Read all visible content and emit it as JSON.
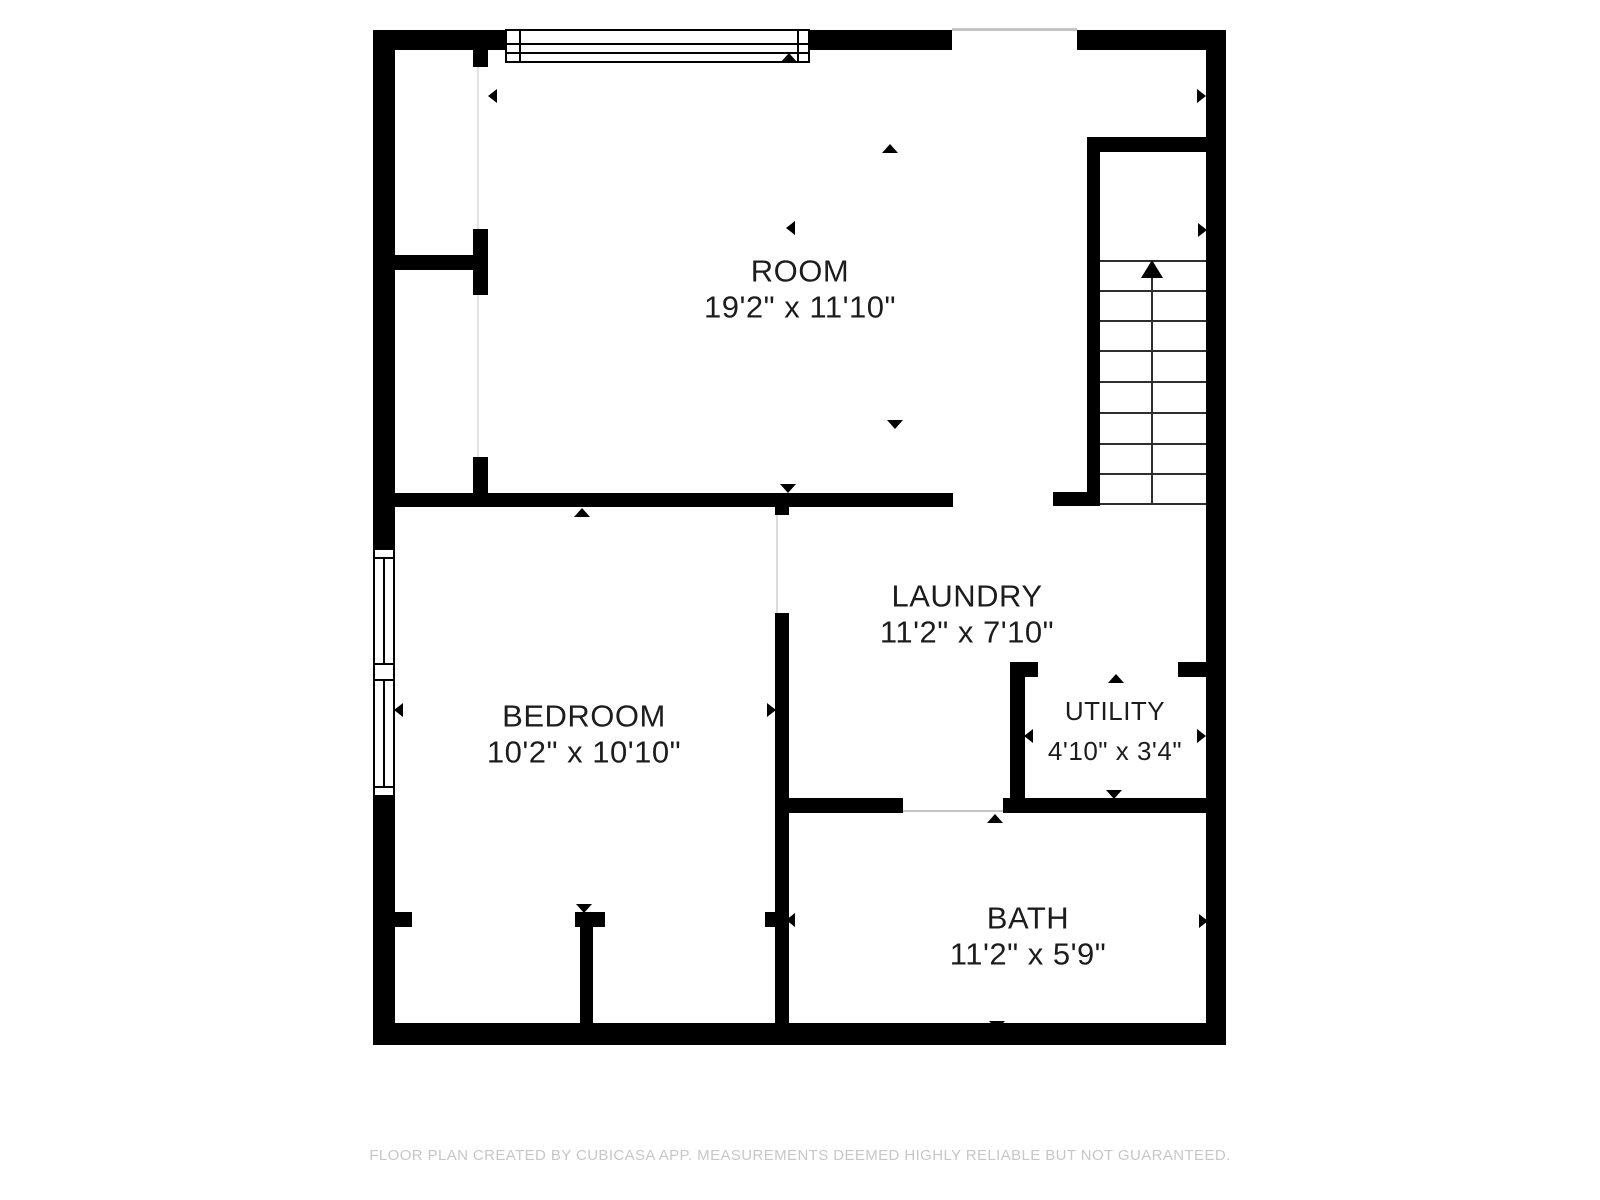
{
  "page": {
    "background": "#ffffff",
    "width": 1600,
    "height": 1200
  },
  "colors": {
    "wall": "#000000",
    "label_text": "#1c1c1c",
    "footer_text": "#c7c7c7",
    "opening_line": "#c4c4c4",
    "stair_line": "#2e2e2e"
  },
  "footer": {
    "text": "FLOOR PLAN CREATED BY CUBICASA APP. MEASUREMENTS DEEMED HIGHLY RELIABLE BUT NOT GUARANTEED.",
    "y": 1147
  },
  "rooms": [
    {
      "id": "room",
      "name": "ROOM",
      "dims": "19'2\" x 11'10\"",
      "x": 800,
      "y": 271,
      "dims_dy": 36,
      "font_size": 31
    },
    {
      "id": "bedroom",
      "name": "BEDROOM",
      "dims": "10'2\" x 10'10\"",
      "x": 584,
      "y": 716,
      "dims_dy": 36,
      "font_size": 31
    },
    {
      "id": "laundry",
      "name": "LAUNDRY",
      "dims": "11'2\" x 7'10\"",
      "x": 967,
      "y": 596,
      "dims_dy": 36,
      "font_size": 31
    },
    {
      "id": "utility",
      "name": "UTILITY",
      "dims": "4'10\" x 3'4\"",
      "x": 1115,
      "y": 711,
      "dims_dy": 40,
      "font_size": 26
    },
    {
      "id": "bath",
      "name": "BATH",
      "dims": "11'2\" x 5'9\"",
      "x": 1028,
      "y": 918,
      "dims_dy": 36,
      "font_size": 31
    }
  ],
  "plan": {
    "walls": [
      {
        "x": 373,
        "y": 30,
        "w": 22,
        "h": 520
      },
      {
        "x": 373,
        "y": 795,
        "w": 22,
        "h": 250
      },
      {
        "x": 373,
        "y": 30,
        "w": 138,
        "h": 20
      },
      {
        "x": 810,
        "y": 30,
        "w": 142,
        "h": 20
      },
      {
        "x": 1077,
        "y": 30,
        "w": 149,
        "h": 20
      },
      {
        "x": 1206,
        "y": 30,
        "w": 20,
        "h": 1015
      },
      {
        "x": 373,
        "y": 1023,
        "w": 853,
        "h": 22
      },
      {
        "x": 395,
        "y": 255,
        "w": 78,
        "h": 15
      },
      {
        "x": 473,
        "y": 50,
        "w": 15,
        "h": 17
      },
      {
        "x": 473,
        "y": 229,
        "w": 15,
        "h": 66
      },
      {
        "x": 473,
        "y": 457,
        "w": 15,
        "h": 36
      },
      {
        "x": 395,
        "y": 493,
        "w": 558,
        "h": 14
      },
      {
        "x": 1053,
        "y": 492,
        "w": 47,
        "h": 14
      },
      {
        "x": 1087,
        "y": 137,
        "w": 13,
        "h": 368
      },
      {
        "x": 1100,
        "y": 137,
        "w": 106,
        "h": 15
      },
      {
        "x": 775,
        "y": 507,
        "w": 14,
        "h": 8
      },
      {
        "x": 775,
        "y": 613,
        "w": 14,
        "h": 410
      },
      {
        "x": 789,
        "y": 798,
        "w": 114,
        "h": 15
      },
      {
        "x": 1003,
        "y": 798,
        "w": 203,
        "h": 15
      },
      {
        "x": 1010,
        "y": 662,
        "w": 15,
        "h": 136
      },
      {
        "x": 1010,
        "y": 662,
        "w": 28,
        "h": 15
      },
      {
        "x": 1178,
        "y": 662,
        "w": 28,
        "h": 15
      },
      {
        "x": 393,
        "y": 912,
        "w": 19,
        "h": 15
      },
      {
        "x": 575,
        "y": 912,
        "w": 30,
        "h": 15
      },
      {
        "x": 580,
        "y": 927,
        "w": 13,
        "h": 96
      },
      {
        "x": 765,
        "y": 912,
        "w": 10,
        "h": 15
      }
    ],
    "opening_lines": [
      {
        "x": 952,
        "y": 28,
        "w": 125,
        "h": 3,
        "c": "#c4c4c4"
      },
      {
        "x": 903,
        "y": 810,
        "w": 100,
        "h": 2,
        "c": "#c4c4c4"
      },
      {
        "x": 776,
        "y": 515,
        "w": 2,
        "h": 98,
        "c": "#dcdcdc"
      },
      {
        "x": 477,
        "y": 67,
        "w": 2,
        "h": 162,
        "c": "#e3e3e3"
      },
      {
        "x": 477,
        "y": 295,
        "w": 2,
        "h": 162,
        "c": "#e3e3e3"
      }
    ],
    "windows": [
      {
        "id": "top-window",
        "x": 505,
        "y": 29,
        "w": 305,
        "h": 34,
        "lines": [
          {
            "x": 505,
            "y": 43,
            "w": 305,
            "h": 2
          },
          {
            "x": 505,
            "y": 52,
            "w": 305,
            "h": 2
          },
          {
            "x": 519,
            "y": 29,
            "w": 2,
            "h": 34
          },
          {
            "x": 797,
            "y": 29,
            "w": 2,
            "h": 34
          }
        ]
      },
      {
        "id": "left-window",
        "x": 373,
        "y": 548,
        "w": 22,
        "h": 249,
        "lines": [
          {
            "x": 373,
            "y": 557,
            "w": 22,
            "h": 2
          },
          {
            "x": 373,
            "y": 663,
            "w": 22,
            "h": 2
          },
          {
            "x": 373,
            "y": 679,
            "w": 22,
            "h": 2
          },
          {
            "x": 373,
            "y": 786,
            "w": 22,
            "h": 2
          },
          {
            "x": 383,
            "y": 557,
            "w": 2,
            "h": 108
          },
          {
            "x": 383,
            "y": 681,
            "w": 2,
            "h": 107
          }
        ]
      }
    ],
    "stairs": {
      "treads": [
        {
          "x": 1100,
          "y": 260,
          "w": 106,
          "h": 2
        },
        {
          "x": 1100,
          "y": 290,
          "w": 106,
          "h": 2
        },
        {
          "x": 1100,
          "y": 320,
          "w": 106,
          "h": 2
        },
        {
          "x": 1100,
          "y": 350,
          "w": 106,
          "h": 2
        },
        {
          "x": 1100,
          "y": 381,
          "w": 106,
          "h": 2
        },
        {
          "x": 1100,
          "y": 412,
          "w": 106,
          "h": 2
        },
        {
          "x": 1100,
          "y": 443,
          "w": 106,
          "h": 2
        },
        {
          "x": 1100,
          "y": 473,
          "w": 106,
          "h": 2
        },
        {
          "x": 1100,
          "y": 503,
          "w": 106,
          "h": 2
        }
      ],
      "center_line": {
        "x": 1151,
        "y": 276,
        "w": 2,
        "h": 228
      },
      "direction_arrow": {
        "x": 1152,
        "y": 269,
        "dir": "up",
        "d": 18,
        "b": 22
      }
    },
    "arrows": [
      {
        "x": 492,
        "y": 96,
        "dir": "left",
        "d": 9,
        "b": 14
      },
      {
        "x": 789,
        "y": 57,
        "dir": "up",
        "d": 9,
        "b": 16
      },
      {
        "x": 1201,
        "y": 96,
        "dir": "right",
        "d": 9,
        "b": 14
      },
      {
        "x": 890,
        "y": 148,
        "dir": "up",
        "d": 9,
        "b": 16
      },
      {
        "x": 790,
        "y": 228,
        "dir": "left",
        "d": 9,
        "b": 14
      },
      {
        "x": 1202,
        "y": 230,
        "dir": "right",
        "d": 9,
        "b": 14
      },
      {
        "x": 895,
        "y": 424,
        "dir": "down",
        "d": 9,
        "b": 16
      },
      {
        "x": 788,
        "y": 488,
        "dir": "down",
        "d": 9,
        "b": 16
      },
      {
        "x": 582,
        "y": 512,
        "dir": "up",
        "d": 9,
        "b": 16
      },
      {
        "x": 398,
        "y": 710,
        "dir": "left",
        "d": 9,
        "b": 14
      },
      {
        "x": 771,
        "y": 710,
        "dir": "right",
        "d": 9,
        "b": 14
      },
      {
        "x": 1116,
        "y": 678,
        "dir": "up",
        "d": 9,
        "b": 16
      },
      {
        "x": 1028,
        "y": 736,
        "dir": "left",
        "d": 9,
        "b": 14
      },
      {
        "x": 1201,
        "y": 736,
        "dir": "right",
        "d": 9,
        "b": 14
      },
      {
        "x": 1114,
        "y": 794,
        "dir": "down",
        "d": 9,
        "b": 16
      },
      {
        "x": 995,
        "y": 818,
        "dir": "up",
        "d": 9,
        "b": 16
      },
      {
        "x": 584,
        "y": 908,
        "dir": "down",
        "d": 9,
        "b": 16
      },
      {
        "x": 790,
        "y": 920,
        "dir": "left",
        "d": 9,
        "b": 14
      },
      {
        "x": 1203,
        "y": 921,
        "dir": "right",
        "d": 9,
        "b": 14
      },
      {
        "x": 997,
        "y": 1025,
        "dir": "down",
        "d": 9,
        "b": 16
      }
    ]
  }
}
